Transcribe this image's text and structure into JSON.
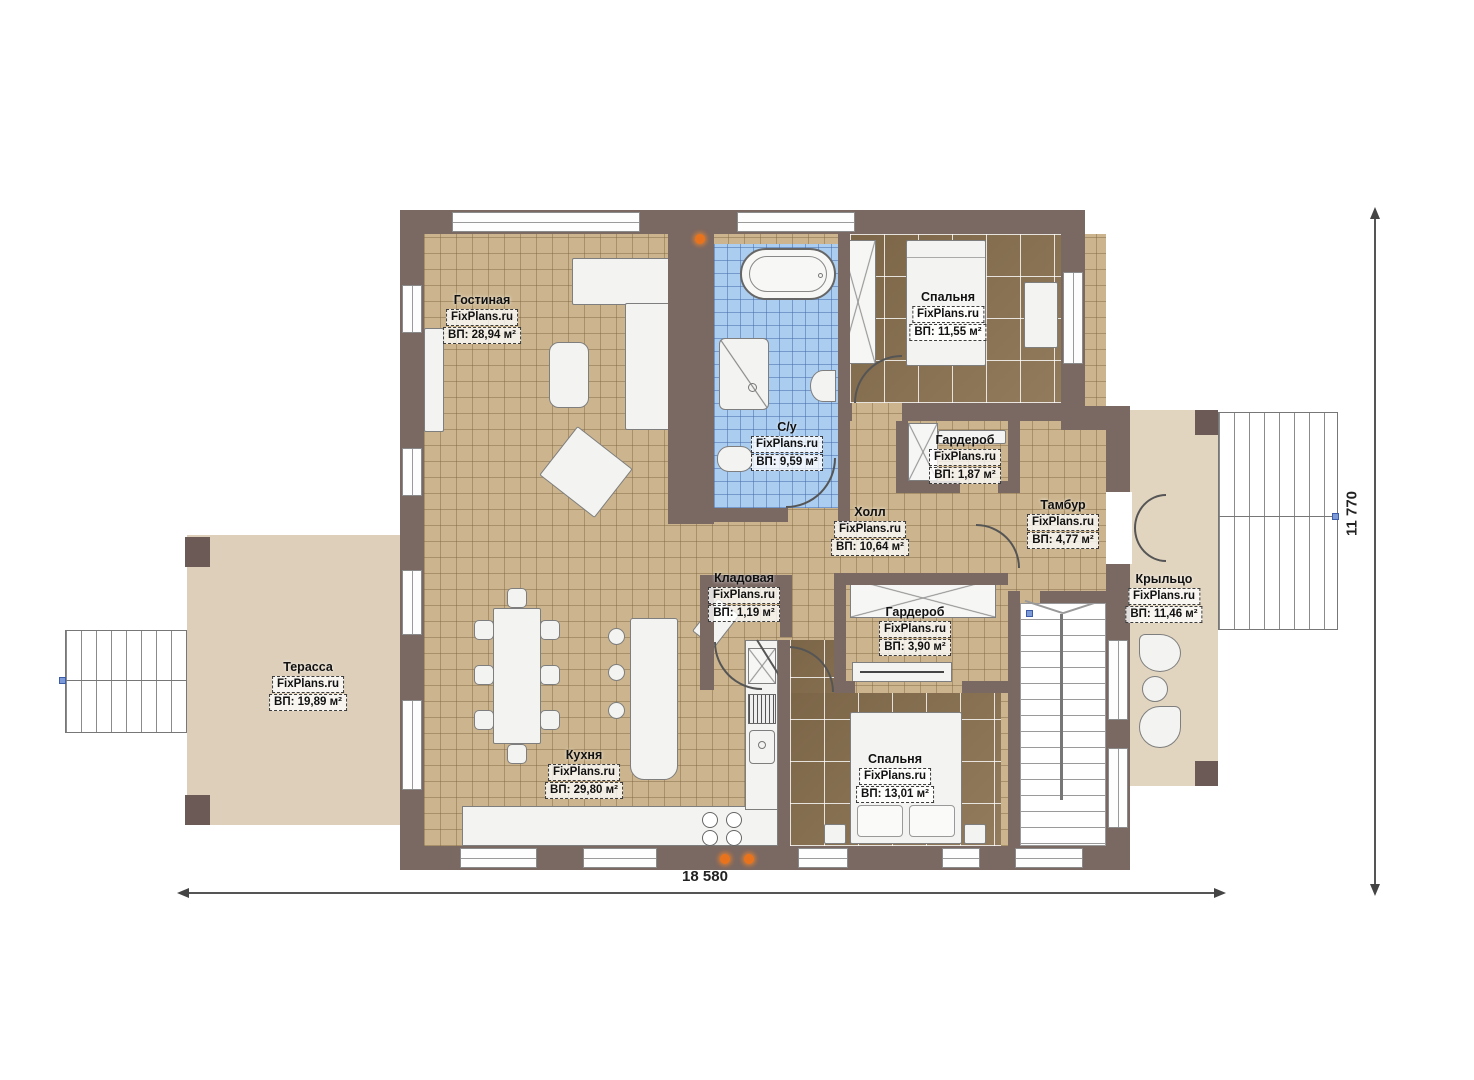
{
  "plan": {
    "brand": "FixPlans.ru",
    "rooms": [
      {
        "key": "living",
        "name": "Гостиная",
        "area": "ВП: 28,94 м²"
      },
      {
        "key": "bedroom1",
        "name": "Спальня",
        "area": "ВП: 11,55 м²"
      },
      {
        "key": "bathroom",
        "name": "С/у",
        "area": "ВП: 9,59 м²"
      },
      {
        "key": "wardrobe1",
        "name": "Гардероб",
        "area": "ВП: 1,87 м²"
      },
      {
        "key": "hall",
        "name": "Холл",
        "area": "ВП: 10,64 м²"
      },
      {
        "key": "vestibule",
        "name": "Тамбур",
        "area": "ВП: 4,77 м²"
      },
      {
        "key": "storage",
        "name": "Кладовая",
        "area": "ВП: 1,19 м²"
      },
      {
        "key": "wardrobe2",
        "name": "Гардероб",
        "area": "ВП: 3,90 м²"
      },
      {
        "key": "bedroom2",
        "name": "Спальня",
        "area": "ВП: 13,01 м²"
      },
      {
        "key": "kitchen",
        "name": "Кухня",
        "area": "ВП: 29,80 м²"
      },
      {
        "key": "terrace",
        "name": "Терасса",
        "area": "ВП: 19,89 м²"
      },
      {
        "key": "porch",
        "name": "Крыльцо",
        "area": "ВП: 11,46 м²"
      }
    ],
    "dimensions": {
      "width": "18 580",
      "height": "11 770"
    },
    "colors": {
      "wall": "#7a6863",
      "tile": "#ccb58e",
      "wood": "#8a7150",
      "bath_tile": "#abcdf0",
      "terrace": "#ddcfba",
      "porch": "#e2d5c0",
      "marker_orange": "#e8731c",
      "marker_blue": "#7d9ad8"
    }
  }
}
